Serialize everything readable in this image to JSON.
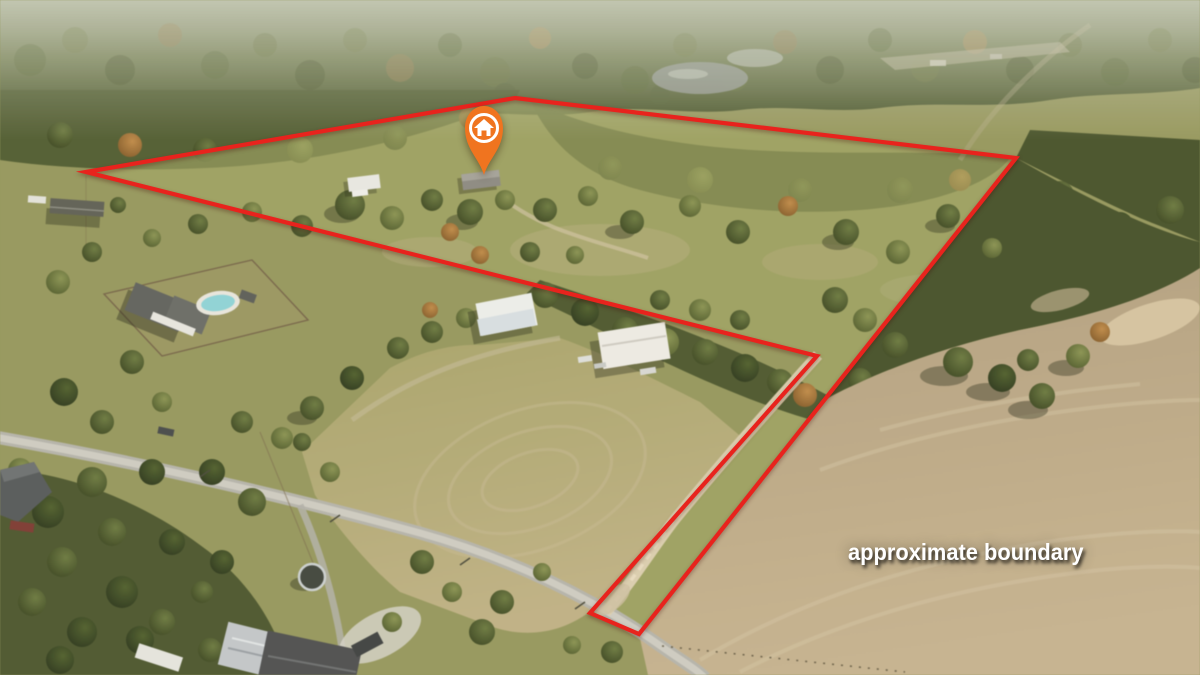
{
  "scene": {
    "kind": "aerial-drone-photo",
    "subject": "rural acreage with pastures, woods, homes, dirt drive and neighboring fields"
  },
  "overlay": {
    "label": "approximate boundary",
    "label_color": "#ffffff",
    "boundary": {
      "color": "#e8231d",
      "stroke_width": "4.2",
      "points": "86,172 515,98 1016,158 639,634 590,613 817,356"
    },
    "marker": {
      "icon": "house-icon",
      "color": "#f0741f",
      "ring_color": "#ffffff",
      "tip_x": "484",
      "tip_y": "175"
    }
  }
}
